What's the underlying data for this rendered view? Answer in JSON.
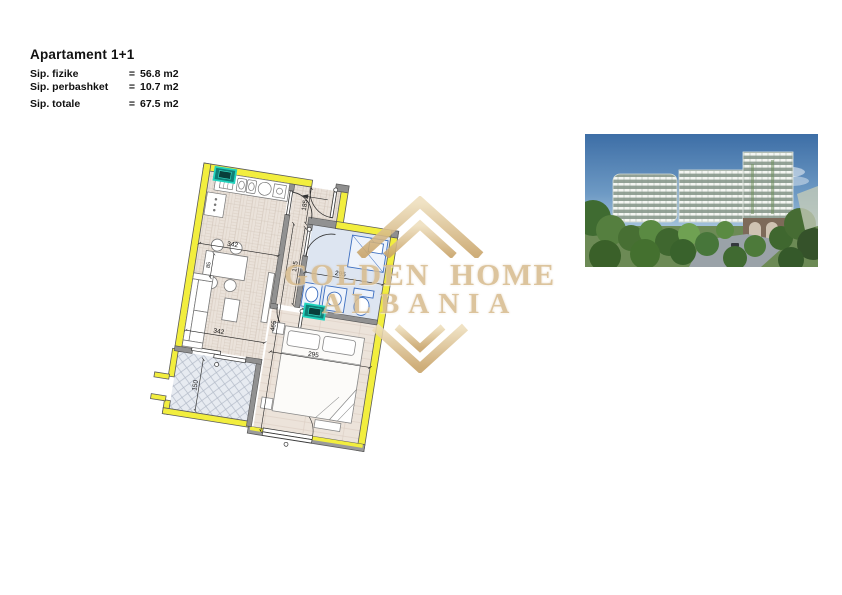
{
  "header": {
    "title": "Apartament 1+1",
    "rows": [
      {
        "label": "Sip. fizike",
        "eq": "=",
        "value": "56.8 m2"
      },
      {
        "label": "Sip. perbashket",
        "eq": "=",
        "value": "10.7 m2"
      },
      {
        "label": "Sip. totale",
        "eq": "=",
        "value": "67.5 m2"
      }
    ]
  },
  "floorplan": {
    "dims": {
      "living_a": "342",
      "living_b": "342",
      "hall_depth": "185",
      "corridor": "105",
      "bath_width": "295",
      "bedroom_width": "295",
      "side_total": "465",
      "balcony_width": "150",
      "table": "85"
    },
    "colors": {
      "wall_yellow": "#f2ee3e",
      "wall_gray": "#919191",
      "bath_blue": "#dde5f1",
      "fixture_blue": "#3c6ec0",
      "marker_teal": "#21d3bd",
      "floor_beige": "#eae2da",
      "balcony_gray": "#e7ebf1"
    }
  },
  "watermark": {
    "line1": "GOLDEN HOME",
    "line2": "ALBANIA",
    "gold": "#d8bd90"
  },
  "photo_colors": {
    "sky": "#3d6ea6",
    "building": "#93a296",
    "trees": "#4d7a3a"
  }
}
